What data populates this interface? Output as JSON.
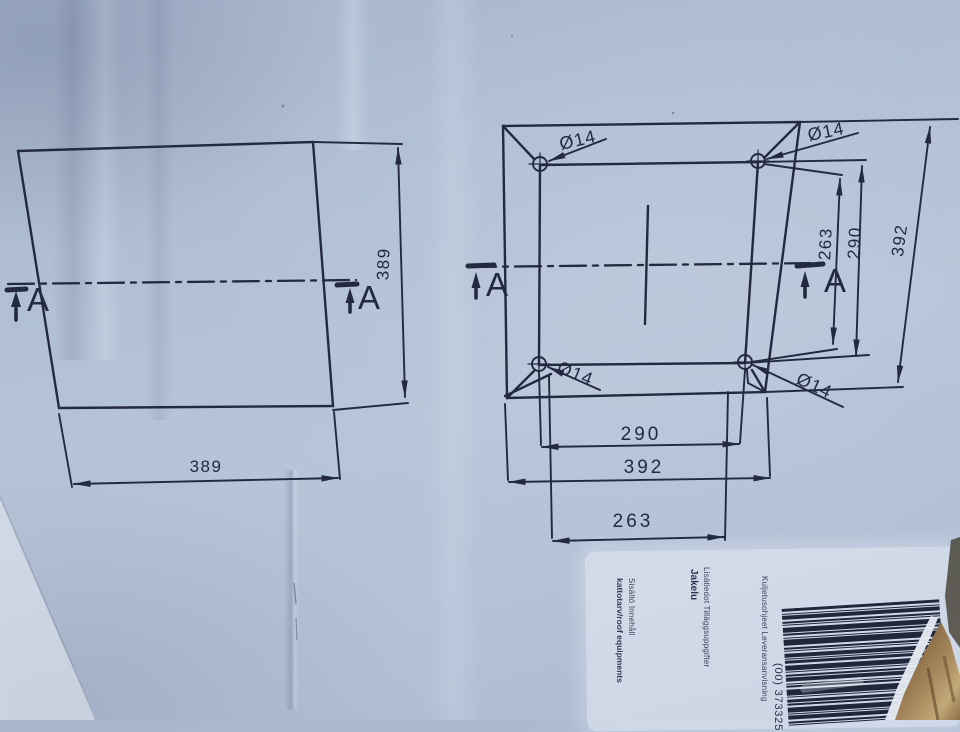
{
  "colors": {
    "ink": "#232a40",
    "surface": "#b2bfd5",
    "label_bg": "#e9eef6",
    "cardboard_light": "#c2a878",
    "cardboard_mid": "#9a7a50",
    "cardboard_dark": "#6b5436"
  },
  "drawing_left": {
    "width_dim": "389",
    "height_dim": "389",
    "section_label": "A"
  },
  "drawing_right": {
    "hole_dia": "Ø14",
    "right_dims": [
      "263",
      "290",
      "392"
    ],
    "bottom_dims": [
      "290",
      "392",
      "263"
    ],
    "section_label": "A"
  },
  "label": {
    "fields": [
      {
        "title": "Sisältö Innehåll",
        "value": "kattotarv/roof equipments"
      },
      {
        "title": "Lisätiedot Tilläggsuppgifter",
        "value": "Jakelu"
      },
      {
        "title": "Kuljetusohjeet Leveransanvisning",
        "value": ""
      }
    ],
    "barcode_number": "(00) 373325",
    "barcode_stripes": [
      [
        3,
        2
      ],
      [
        1,
        1
      ],
      [
        4,
        2
      ],
      [
        2,
        1
      ],
      [
        1,
        2
      ],
      [
        5,
        1
      ],
      [
        2,
        2
      ],
      [
        1,
        1
      ],
      [
        6,
        2
      ],
      [
        2,
        1
      ],
      [
        1,
        2
      ],
      [
        4,
        1
      ],
      [
        1,
        1
      ],
      [
        3,
        2
      ],
      [
        5,
        1
      ],
      [
        1,
        2
      ],
      [
        2,
        1
      ],
      [
        4,
        2
      ],
      [
        1,
        1
      ],
      [
        2,
        2
      ],
      [
        6,
        1
      ],
      [
        1,
        2
      ],
      [
        3,
        1
      ],
      [
        2,
        2
      ],
      [
        5,
        1
      ],
      [
        1,
        1
      ],
      [
        4,
        2
      ],
      [
        2,
        1
      ],
      [
        1,
        2
      ],
      [
        3,
        1
      ],
      [
        2,
        1
      ]
    ]
  }
}
